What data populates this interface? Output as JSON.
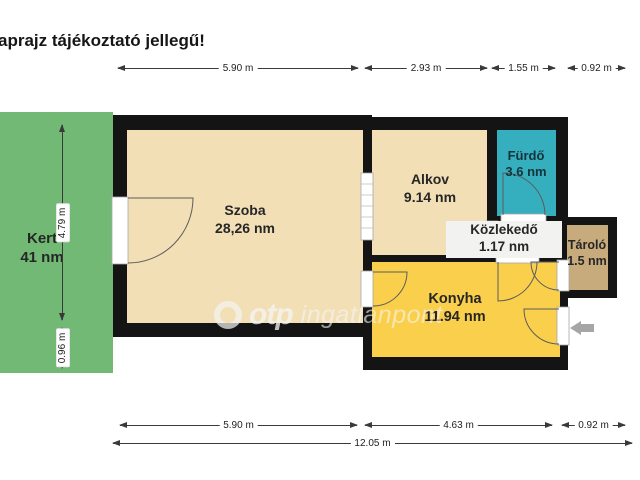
{
  "title": "aprajz tájékoztató jellegű!",
  "garden": {
    "name": "Kert",
    "area": "41 nm"
  },
  "rooms": {
    "szoba": {
      "name": "Szoba",
      "area": "28,26 nm"
    },
    "alkov": {
      "name": "Alkov",
      "area": "9.14 nm"
    },
    "furdo": {
      "name": "Fürdő",
      "area": "3.6 nm"
    },
    "kozlekedo": {
      "name": "Közlekedő",
      "area": "1.17 nm"
    },
    "tarolo": {
      "name": "Tároló",
      "area": "1.5 nm"
    },
    "konyha": {
      "name": "Konyha",
      "area": "11.94 nm"
    }
  },
  "dimensions": {
    "top": [
      "5.90 m",
      "2.93 m",
      "1.55 m",
      "0.92 m"
    ],
    "left": [
      "4.79 m",
      "0.96 m"
    ],
    "bottom": [
      "5.90 m",
      "4.63 m",
      "0.92 m"
    ],
    "total": "12.05 m"
  },
  "watermark": {
    "brand": "otp",
    "text": "ingatlanpont"
  },
  "icons": {
    "entrance": "entrance-arrow-icon",
    "logo": "otp-logo-icon"
  },
  "colors": {
    "garden": "#72B975",
    "room": "#F2DFB6",
    "bathroom": "#35AEBD",
    "kitchen": "#FACF4B",
    "storage": "#C8AB7D",
    "hallway": "#EFEFED",
    "wall": "#141414",
    "entrance_arrow": "#A6A6A6"
  }
}
